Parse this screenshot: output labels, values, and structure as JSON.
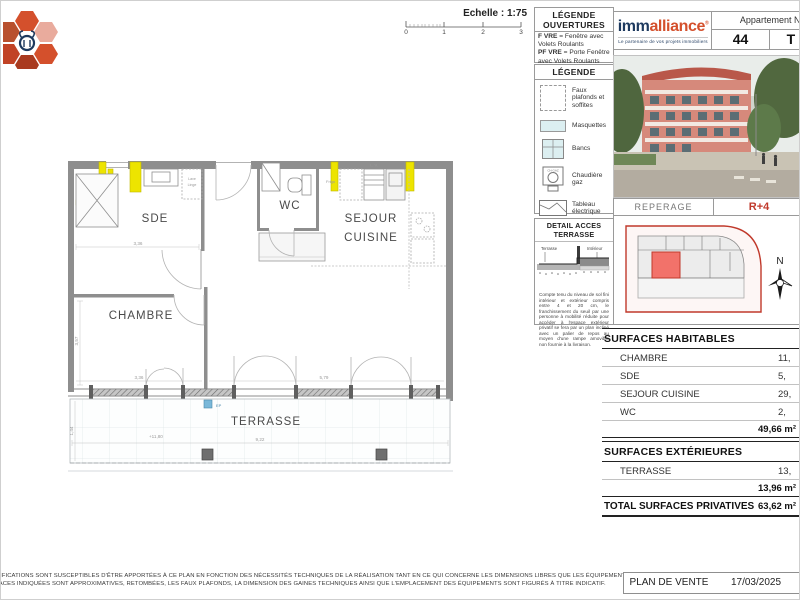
{
  "scale": {
    "label": "Echelle : 1:75",
    "ticks": [
      "0",
      "1",
      "2",
      "3"
    ]
  },
  "legende_ouvertures": {
    "title_line1": "LÉGENDE",
    "title_line2": "OUVERTURES",
    "f_bold": "F VRE",
    "f_rest": " = Fenêtre avec Volets Roulants",
    "pf_bold": "PF VRE",
    "pf_rest": " = Porte Fenêtre avec Volets Roulants"
  },
  "legende": {
    "title": "LÉGENDE",
    "items": [
      {
        "icon": "dashed-square-icon",
        "label": "Faux plafonds et soffites"
      },
      {
        "icon": "masquette-icon",
        "label": "Masquettes"
      },
      {
        "icon": "banc-icon",
        "label": "Bancs"
      },
      {
        "icon": "boiler-icon",
        "label": "Chaudière gaz"
      },
      {
        "icon": "electric-panel-icon",
        "label": "Tableau électrique"
      },
      {
        "icon": "gutter-icon",
        "label": "Canniveau"
      }
    ]
  },
  "detail_acces": {
    "title": "DETAIL ACCES TERRASSE",
    "label_terrasse": "Terrasse",
    "label_interieur": "Intérieur",
    "note": "Compte tenu du niveau de sol fini intérieur et extérieur compris entre 4 et 20 cm, le franchissement du seuil par une personne à mobilité réduite pour accéder à l'espace extérieur privatif se fera par un plan incliné avec un palier de repos au moyen d'une rampe amovible non fournie à la livraison."
  },
  "header": {
    "brand_part1": "imm",
    "brand_part2": "alliance",
    "brand_mark": "®",
    "tagline": "Le partenaire de vos projets immobiliers",
    "apartment_label": "Appartement N°",
    "apartment_number": "44",
    "apartment_type": "T - 2"
  },
  "reperage": {
    "label": "REPERAGE",
    "floor": "R+4",
    "north": "N"
  },
  "surfaces": {
    "habitables_title": "SURFACES HABITABLES",
    "habitables_rows": [
      {
        "label": "CHAMBRE",
        "value": "11,"
      },
      {
        "label": "SDE",
        "value": "5,"
      },
      {
        "label": "SEJOUR CUISINE",
        "value": "29,"
      },
      {
        "label": "WC",
        "value": "2,"
      }
    ],
    "habitables_total": "49,66 m²",
    "exterieures_title": "SURFACES EXTÉRIEURES",
    "exterieures_rows": [
      {
        "label": "TERRASSE",
        "value": "13,"
      }
    ],
    "exterieures_total": "13,96 m²",
    "total_label": "TOTAL SURFACES PRIVATIVES",
    "total_value": "63,62 m²"
  },
  "plan": {
    "rooms": {
      "sde": "SDE",
      "wc": "WC",
      "sejour_line1": "SEJOUR",
      "sejour_line2": "CUISINE",
      "chambre": "CHAMBRE",
      "terrasse": "TERRASSE"
    },
    "fixtures": {
      "lave_linge_1": "Lave",
      "lave_linge_2": "Linge",
      "frigo": "Frigo",
      "lv": "L. V."
    },
    "dims": {
      "sde_width": "3,36",
      "chambre_width": "3,36",
      "chambre_height": "3,57",
      "sejour_width": "5,79",
      "terrasse_width": "9,22",
      "terrasse_depth": "1,44",
      "level": "+11,80"
    },
    "window_label": "PF VRE",
    "ep_label": "EP"
  },
  "footer": {
    "disclaimer_line1": "ODIFICATIONS SONT SUSCEPTIBLES D'ÊTRE APPORTÉES À CE PLAN EN FONCTION DES NÉCESSITÉS TECHNIQUES DE LA RÉALISATION TANT EN CE QUI CONCERNE LES DIMENSIONS LIBRES QUE LES ÉQUIPEMENTS.",
    "disclaimer_line2": "RFACES INDIQUÉES SONT APPROXIMATIVES, RETOMBÉES, LES FAUX PLAFONDS, LA DIMENSION DES GAINES TECHNIQUES AINSI QUE L'EMPLACEMENT DES ÉQUIPEMENTS SONT FIGURÉS À TITRE INDICATIF.",
    "doc_type": "PLAN DE VENTE",
    "date": "17/03/2025"
  },
  "colors": {
    "accent_red": "#c0392b",
    "brand_navy": "#1e3a5f",
    "brand_orange": "#d4502c",
    "highlight_yellow": "#ede400",
    "unit_fill": "#f2726a"
  }
}
